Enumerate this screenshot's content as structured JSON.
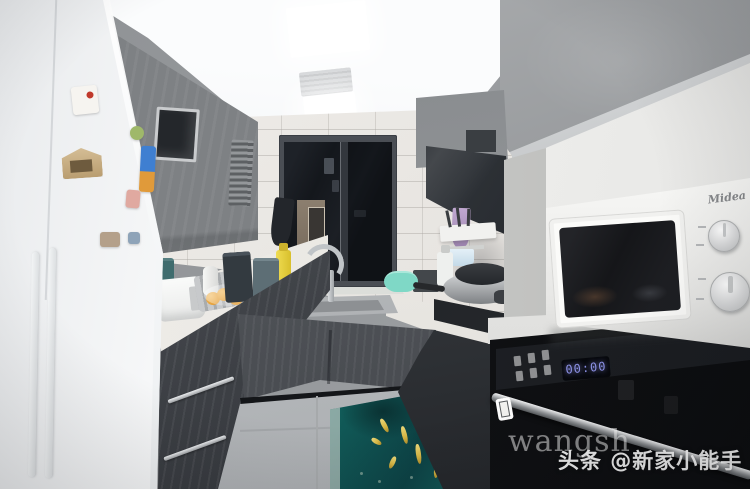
{
  "image": {
    "type": "photograph",
    "subject": "Galley kitchen with gray wood cabinets, white quartz countertops, white refrigerator with magnets, window over sink, range hood, Midea microwave in niche and black built-in oven, teal koi-fish floor mat",
    "width_px": 750,
    "height_px": 489
  },
  "watermarks": {
    "partial": "wangsh",
    "credit": "头条 @新家小能手"
  },
  "appliances": {
    "microwave": {
      "brand": "Midea"
    },
    "oven": {
      "display": "00:00"
    }
  },
  "colors": {
    "cabinet-gray": "#808488",
    "cabinet-dark": "#4a4d52",
    "counter-white": "#edebe7",
    "tile-white": "#ece9e5",
    "floor-gray": "#bfc2c4",
    "mat-teal": "#12605c",
    "fish-gold": "#d8b845",
    "oven-black": "#131519",
    "display-blue": "#8e93e8",
    "fridge-white": "#f7f8f9"
  }
}
